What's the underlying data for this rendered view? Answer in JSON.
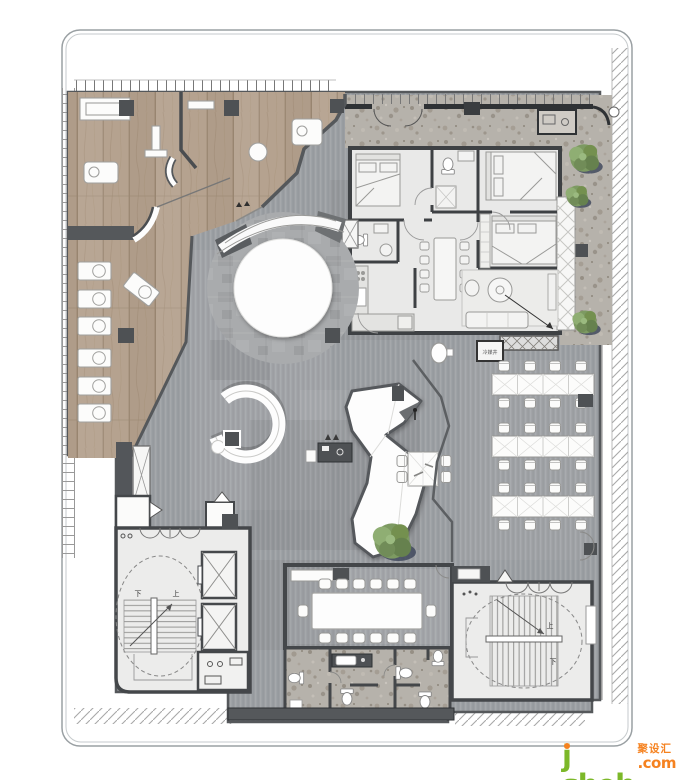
{
  "meta": {
    "kind": "rendered interior floor plan",
    "floor_textures": [
      "wood plank",
      "ribbed gray carpet",
      "terrazzo",
      "mottled concrete"
    ]
  },
  "labels": {
    "stair_up": "上",
    "stair_down": "下",
    "utility_shaft": "冷媒井"
  },
  "watermark": {
    "brand_j": "j",
    "brand_rest": "sheh",
    "brand_cn": "聚设汇",
    "tld": ".com",
    "green": "#7cb829",
    "orange": "#f58220"
  },
  "inventory": {
    "display_tables": 7,
    "office_desk_rows": 3,
    "office_desks_per_row": 4,
    "office_seats": 24,
    "conference_seats": 14,
    "dining_seats": 8,
    "bedrooms": 3,
    "bathrooms": 2,
    "elevators": 2,
    "staircases": 2,
    "trees": 4,
    "toilets": 6
  },
  "zones": [
    {
      "id": "display-gallery",
      "desc": "wood-floor display gallery with plinth tables"
    },
    {
      "id": "central-feature",
      "desc": "circular feature with curved reception counter"
    },
    {
      "id": "show-flat",
      "desc": "3-bedroom show flat with dining and living room"
    },
    {
      "id": "terrace",
      "desc": "terrazzo terrace with planting"
    },
    {
      "id": "open-office",
      "desc": "open office bench desks"
    },
    {
      "id": "conference-room",
      "desc": "14-seat conference room"
    },
    {
      "id": "restrooms",
      "desc": "washroom block on terrazzo"
    },
    {
      "id": "core-west",
      "desc": "west core: stair and two elevators"
    },
    {
      "id": "stair-east",
      "desc": "east scissor stair"
    }
  ],
  "colors": {
    "wood": "#b5a28f",
    "carpet": "#9b9ea2",
    "terrazzo": "#b6b2ab",
    "room_fill": "#e9e9e8",
    "wall": "#3e4144",
    "wall_light": "#55585b",
    "sculpture": "#fdfdfd",
    "tree": "#7d9a62",
    "tree_shadow": "#3b4459"
  }
}
